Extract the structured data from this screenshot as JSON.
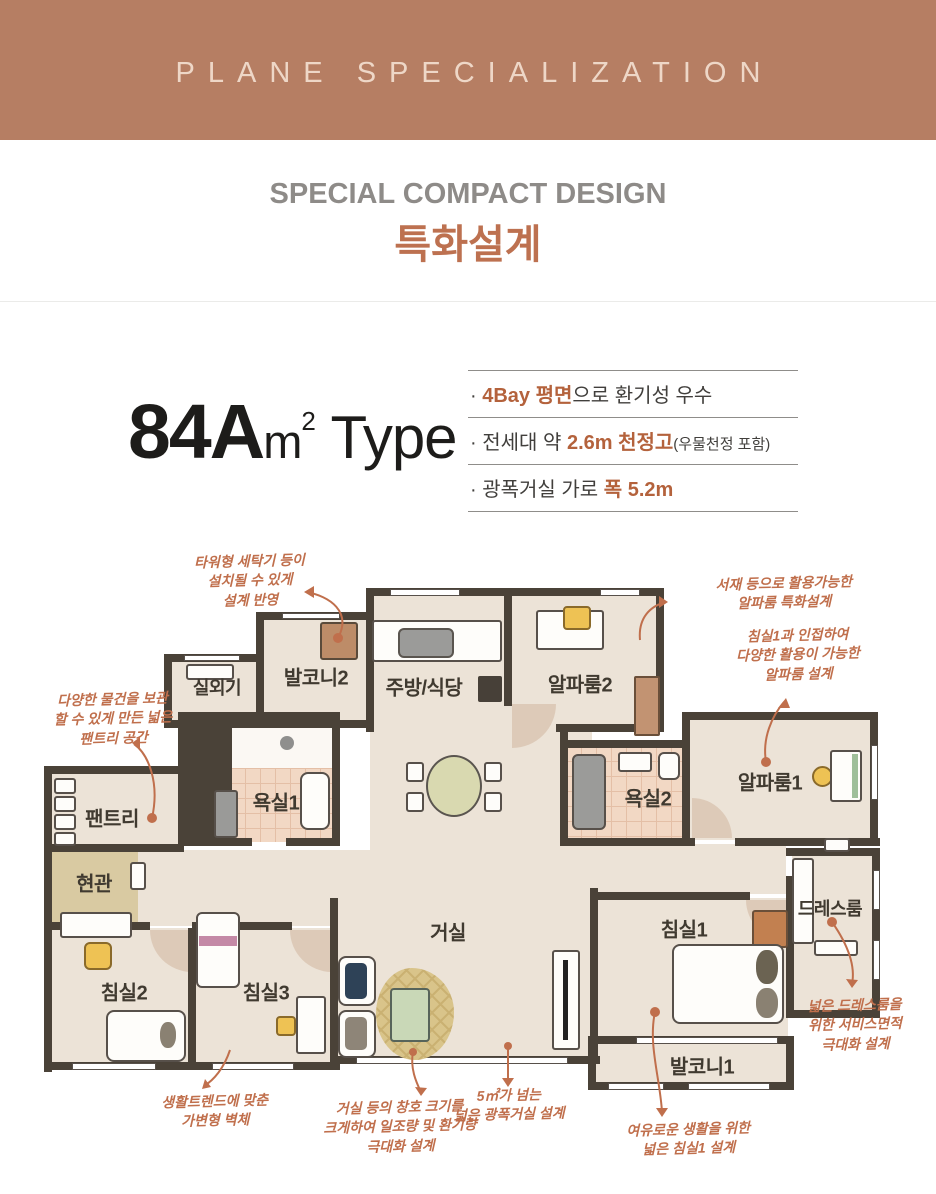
{
  "colors": {
    "header_bg": "#b67e63",
    "accent_text": "#bd7150",
    "highlight": "#b4623c",
    "annotation": "#c06f4c",
    "wall": "#4a4238"
  },
  "header": {
    "title": "PLANE SPECIALIZATION"
  },
  "intro": {
    "title_en": "SPECIAL COMPACT DESIGN",
    "title_ko": "특화설계"
  },
  "unit": {
    "name": "84A",
    "area_unit": "m",
    "area_sup": "2",
    "type_label": " Type"
  },
  "features": {
    "bullet": "·",
    "items": [
      {
        "pre": "",
        "hl": "4Bay 평면",
        "rest": "으로 환기성 우수",
        "note": ""
      },
      {
        "pre": "전세대 약 ",
        "hl": "2.6m 천정고",
        "rest": "",
        "note": "(우물천정 포함)"
      },
      {
        "pre": "광폭거실 가로 ",
        "hl": "폭 5.2m",
        "rest": "",
        "note": ""
      }
    ]
  },
  "plan": {
    "rooms": [
      {
        "label": "실외기"
      },
      {
        "label": "발코니2"
      },
      {
        "label": "주방/식당"
      },
      {
        "label": "알파룸2"
      },
      {
        "label": "팬트리"
      },
      {
        "label": "욕실1"
      },
      {
        "label": "욕실2"
      },
      {
        "label": "알파룸1"
      },
      {
        "label": "현관"
      },
      {
        "label": "드레스룸"
      },
      {
        "label": "침실2"
      },
      {
        "label": "침실3"
      },
      {
        "label": "거실"
      },
      {
        "label": "침실1"
      },
      {
        "label": "발코니1"
      }
    ],
    "annotations": [
      {
        "lines": [
          "타워형 세탁기 등이",
          "설치될 수 있게",
          "설계 반영"
        ]
      },
      {
        "lines": [
          "서재 등으로 활용가능한",
          "알파룸 특화설계"
        ]
      },
      {
        "lines": [
          "침실1과 인접하여",
          "다양한 활용이 가능한",
          "알파룸 설계"
        ]
      },
      {
        "lines": [
          "다양한 물건을 보관",
          "할 수 있게 만든 넓은",
          "팬트리 공간"
        ]
      },
      {
        "lines": [
          "넓은 드레스룸을",
          "위한 서비스면적",
          "극대화 설계"
        ]
      },
      {
        "lines": [
          "생활트렌드에 맞춘",
          "가변형 벽체"
        ]
      },
      {
        "lines": [
          "거실 등의 창호 크기를",
          "크게하여 일조량 및 환기량",
          "극대화 설계"
        ]
      },
      {
        "lines": [
          "5㎡가 넘는",
          "넓은 광폭거실 설계"
        ]
      },
      {
        "lines": [
          "여유로운 생활을 위한",
          "넓은 침실1 설계"
        ]
      }
    ]
  }
}
